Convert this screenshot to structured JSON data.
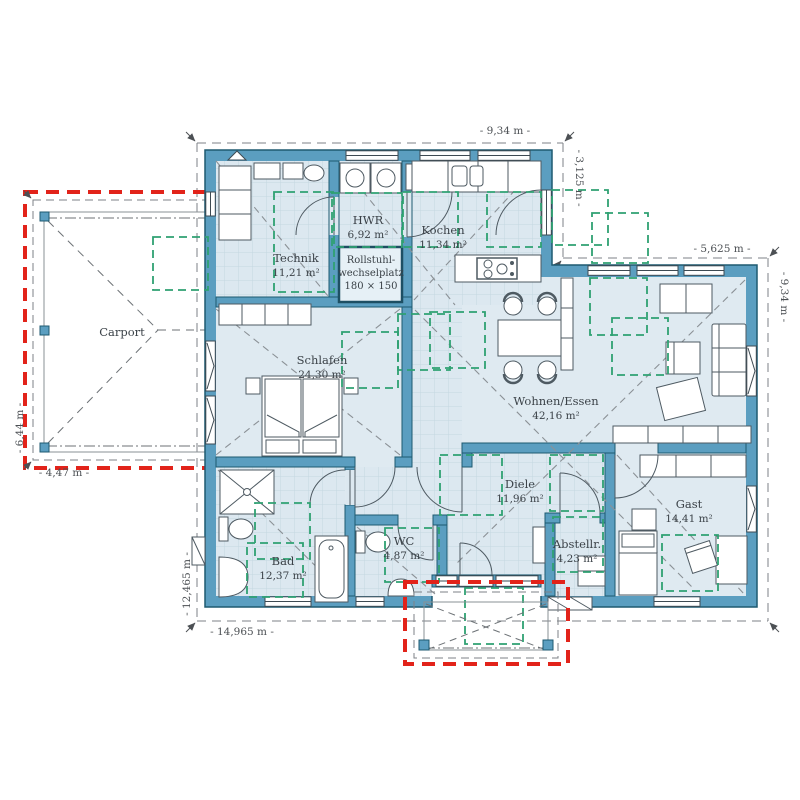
{
  "title": "Bungalow Grundriss (floor plan)",
  "dimensions": {
    "top": "- 9,34 m -",
    "notch_right": "- 3,125 m -",
    "notch_top": "- 5,625 m -",
    "right": "- 9,34 m -",
    "bottom": "- 14,965 m -",
    "left": "- 12,465 m -",
    "carport_left": "- 6,44 m -",
    "carport_bottom": "- 4,47 m -"
  },
  "rooms": {
    "carport": {
      "name": "Carport",
      "area": ""
    },
    "technik": {
      "name": "Technik",
      "area": "11,21 m²"
    },
    "hwr": {
      "name": "HWR",
      "area": "6,92 m²"
    },
    "rollstuhl": {
      "line1": "Rollstuhl-",
      "line2": "wechselplatz",
      "line3": "180 × 150"
    },
    "kochen": {
      "name": "Kochen",
      "area": "11,34 m²"
    },
    "schlafen": {
      "name": "Schlafen",
      "area": "24,30 m²"
    },
    "wohnen": {
      "name": "Wohnen/Essen",
      "area": "42,16 m²"
    },
    "diele": {
      "name": "Diele",
      "area": "11,96 m²"
    },
    "bad": {
      "name": "Bad",
      "area": "12,37 m²"
    },
    "wc": {
      "name": "WC",
      "area": "4,87 m²"
    },
    "abstellraum": {
      "name": "Abstellr.",
      "area": "4,23 m²"
    },
    "gast": {
      "name": "Gast",
      "area": "14,41 m²"
    }
  },
  "colors": {
    "wall_fill": "#5b9ec0",
    "wall_edge": "#1e5a70",
    "floor": "#dfeaf1",
    "tile_line": "#c4d7e1",
    "green_zone": "#2fa172",
    "red_outline": "#e2231a",
    "gray_line": "#84898e",
    "dim_text": "#4c5054",
    "label_text": "#3b4248",
    "furniture_line": "#4e5a62"
  }
}
